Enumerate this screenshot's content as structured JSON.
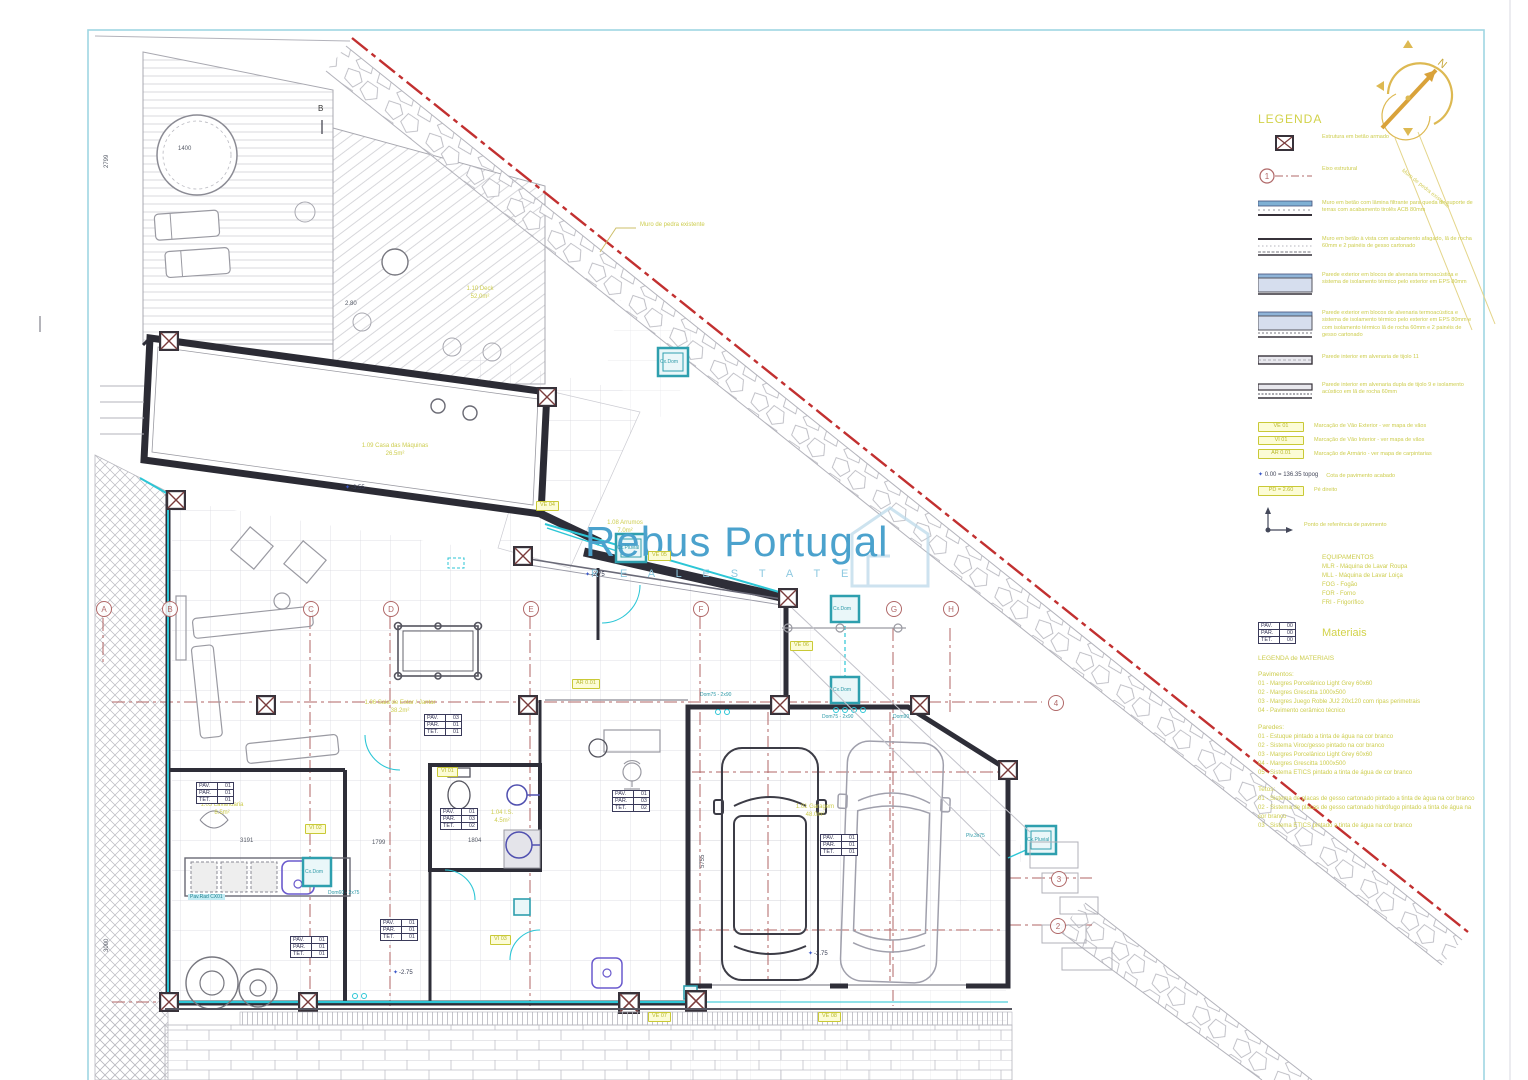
{
  "page": {
    "brand": "Rebus Portugal",
    "brand_sub": "R E A L   E S T A T E"
  },
  "legend": {
    "title": "LEGENDA",
    "axis_sample": "1",
    "sym_items": [
      {
        "label": "Estrutura em betão armado"
      },
      {
        "label": "Eixo estrutural"
      },
      {
        "label": "Muro em betão com lâmina filtrante para queda de suporte de terras com acabamento tirolês ACB 80mm"
      },
      {
        "label": "Muro em betão à vista com acabamento afagado, lã de rocha 60mm e 2 painéis de gesso cartonado"
      },
      {
        "label": "Parede exterior em blocos de alvenaria termoacústica e sistema de isolamento térmico pelo exterior em EPS 80mm"
      },
      {
        "label": "Parede exterior em blocos de alvenaria termoacústica e sistema de isolamento térmico pelo exterior em EPS 80mm e com isolamento térmico lã de rocha 60mm e 2 painéis de gesso cartonado"
      },
      {
        "label": "Parede interior em alvenaria de tijolo 11"
      },
      {
        "label": "Parede interior em alvenaria dupla de tijolo 9 e isolamento acústico em lã de rocha 60mm"
      }
    ],
    "tags": [
      {
        "code": "VE 01",
        "label": "Marcação de Vão Exterior - ver mapa de vãos"
      },
      {
        "code": "VI 01",
        "label": "Marcação de Vão Interior - ver mapa de vãos"
      },
      {
        "code": "AR 0.01",
        "label": "Marcação de Armário - ver mapa de carpintarias"
      }
    ],
    "level_code": "0.00 = 136.35 topog",
    "level_label": "Cota de pavimento acabado",
    "pd_code": "PD = 2.60",
    "pd_label": "Pé direito",
    "axis_label": "Ponto de referência de pavimento",
    "equip_title": "EQUIPAMENTOS",
    "equipment": [
      "MLR - Máquina de Lavar Roupa",
      "MLL - Máquina de Lavar Loiça",
      "FOG - Fogão",
      "FOR - Forno",
      "FRI - Frigorífico"
    ],
    "mat_box": {
      "pav": "PAV.",
      "par": "PAR.",
      "tet": "TET.",
      "v": "00",
      "title": "Materiais"
    },
    "mat_legend_title": "LEGENDA de MATERIAIS",
    "pav_title": "Pavimentos:",
    "pavimentos": [
      "01 - Margres Porcelânico Light Grey 60x60",
      "02 - Margres Grescitta 1000x500",
      "03 - Margres Juego Roble JU2 20x120 com ripas perimetrais",
      "04 - Pavimento cerâmico técnico"
    ],
    "par_title": "Paredes:",
    "paredes": [
      "01 - Estuque pintado a tinta de água na cor branco",
      "02 - Sistema Viroc/gesso pintado na cor branco",
      "03 - Margres Porcelânico Light Grey 60x60",
      "04 - Margres Grescitta 1000x500",
      "05 - Sistema ETICS pintado a tinta de água de cor branco"
    ],
    "tet_title": "Tetos:",
    "tetos": [
      "01 - Sistema de placas de gesso cartonado pintado a tinta de água na cor branco",
      "02 - Sistema de placas de gesso cartonado hidrófugo pintado a tinta de água na cor branco",
      "03 - Sistema ETICS pintado a tinta de água na cor branco"
    ]
  },
  "plan": {
    "north": "N",
    "section_marker": "B",
    "grid_letters": [
      "A",
      "B",
      "C",
      "D",
      "E",
      "F",
      "G",
      "H"
    ],
    "grid_numbers": [
      "4",
      "3",
      "2"
    ],
    "rooms": [
      {
        "name": "1.09 Casa das Máquinas",
        "area": "26.5m²"
      },
      {
        "name": "1.08 Arrumos",
        "area": "7.0m²"
      },
      {
        "name": "1.06 Sala de Estar / Jantar",
        "area": "38.2m²"
      },
      {
        "name": "1.05 Lavandaria",
        "area": "8.5m²"
      },
      {
        "name": "1.04 I.S.",
        "area": "4.5m²"
      },
      {
        "name": "1.01 Garagem",
        "area": "48.0m²"
      },
      {
        "name": "1.10 Deck",
        "area": "52.0m²"
      }
    ],
    "table_rows": {
      "pav": "PAV.",
      "par": "PAR.",
      "tet": "TET."
    },
    "tables": [
      {
        "pav": "01",
        "par": "01",
        "tet": "01"
      },
      {
        "pav": "03",
        "par": "01",
        "tet": "01"
      },
      {
        "pav": "01",
        "par": "03",
        "tet": "02"
      },
      {
        "pav": "01",
        "par": "03",
        "tet": "02"
      },
      {
        "pav": "01",
        "par": "01",
        "tet": "01"
      },
      {
        "pav": "01",
        "par": "01",
        "tet": "01"
      },
      {
        "pav": "01",
        "par": "01",
        "tet": "01"
      }
    ],
    "elevations": [
      "-3.55",
      "-2.75",
      "-2.75",
      "-2.75"
    ],
    "dims": [
      "1400",
      "2.80",
      "3191",
      "1799",
      "1804",
      "2799",
      "3000",
      "5755"
    ],
    "ve_tags": [
      "VE 04",
      "VE 05",
      "VE 06",
      "AR 0.01",
      "VI 02",
      "VI 01",
      "VI 03",
      "VE 07",
      "VE 08"
    ],
    "cx_labels": [
      "Cx.Dom",
      "Cx.Pluvial",
      "Cx.Dom",
      "Cx.Dom",
      "Cx.Dom",
      "Cx.Pluvial"
    ],
    "pipe_labels": [
      "Dom75 - 2x90",
      "Dom90",
      "Plv.3x75",
      "Dom60 - 2x75",
      "Pav.Rad CX01"
    ],
    "callout": "Muro de pedra existente",
    "boundary_label": "Muro de pedra existente"
  }
}
